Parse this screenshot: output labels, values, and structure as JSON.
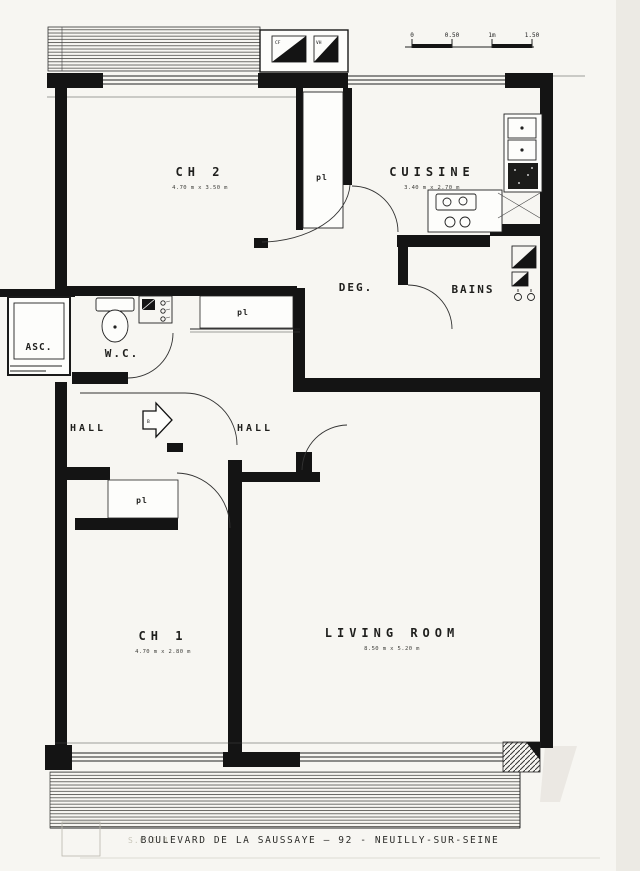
{
  "plan": {
    "rooms": {
      "ch2": {
        "label": "CH 2",
        "dims": "4.70 m x 3.50 m"
      },
      "cuisine": {
        "label": "CUISINE",
        "dims": "3.40 m x 2.70 m"
      },
      "deg": {
        "label": "DEG."
      },
      "bains": {
        "label": "BAINS"
      },
      "wc": {
        "label": "W.C."
      },
      "asc": {
        "label": "ASC."
      },
      "hall_west": {
        "label": "HALL"
      },
      "hall_east": {
        "label": "HALL"
      },
      "ch1": {
        "label": "CH 1",
        "dims": "4.70 m x 2.80 m"
      },
      "living": {
        "label": "LIVING ROOM",
        "dims": "8.50 m x 5.20 m"
      }
    },
    "closets": {
      "pl_ch2": "pl",
      "pl_corridor": "pl",
      "pl_hall": "pl"
    },
    "shafts": {
      "left": "CF",
      "right": "VH"
    },
    "entrance_arrow_letter": "B",
    "scale_bar": {
      "tick0": "0",
      "tick1": "0.50",
      "tick2": "1m",
      "tick3": "1.50"
    },
    "footer": {
      "company": "S.C.I.",
      "number": "4",
      "address": "BOULEVARD DE LA SAUSSAYE — 92 - NEUILLY-SUR-SEINE"
    }
  }
}
